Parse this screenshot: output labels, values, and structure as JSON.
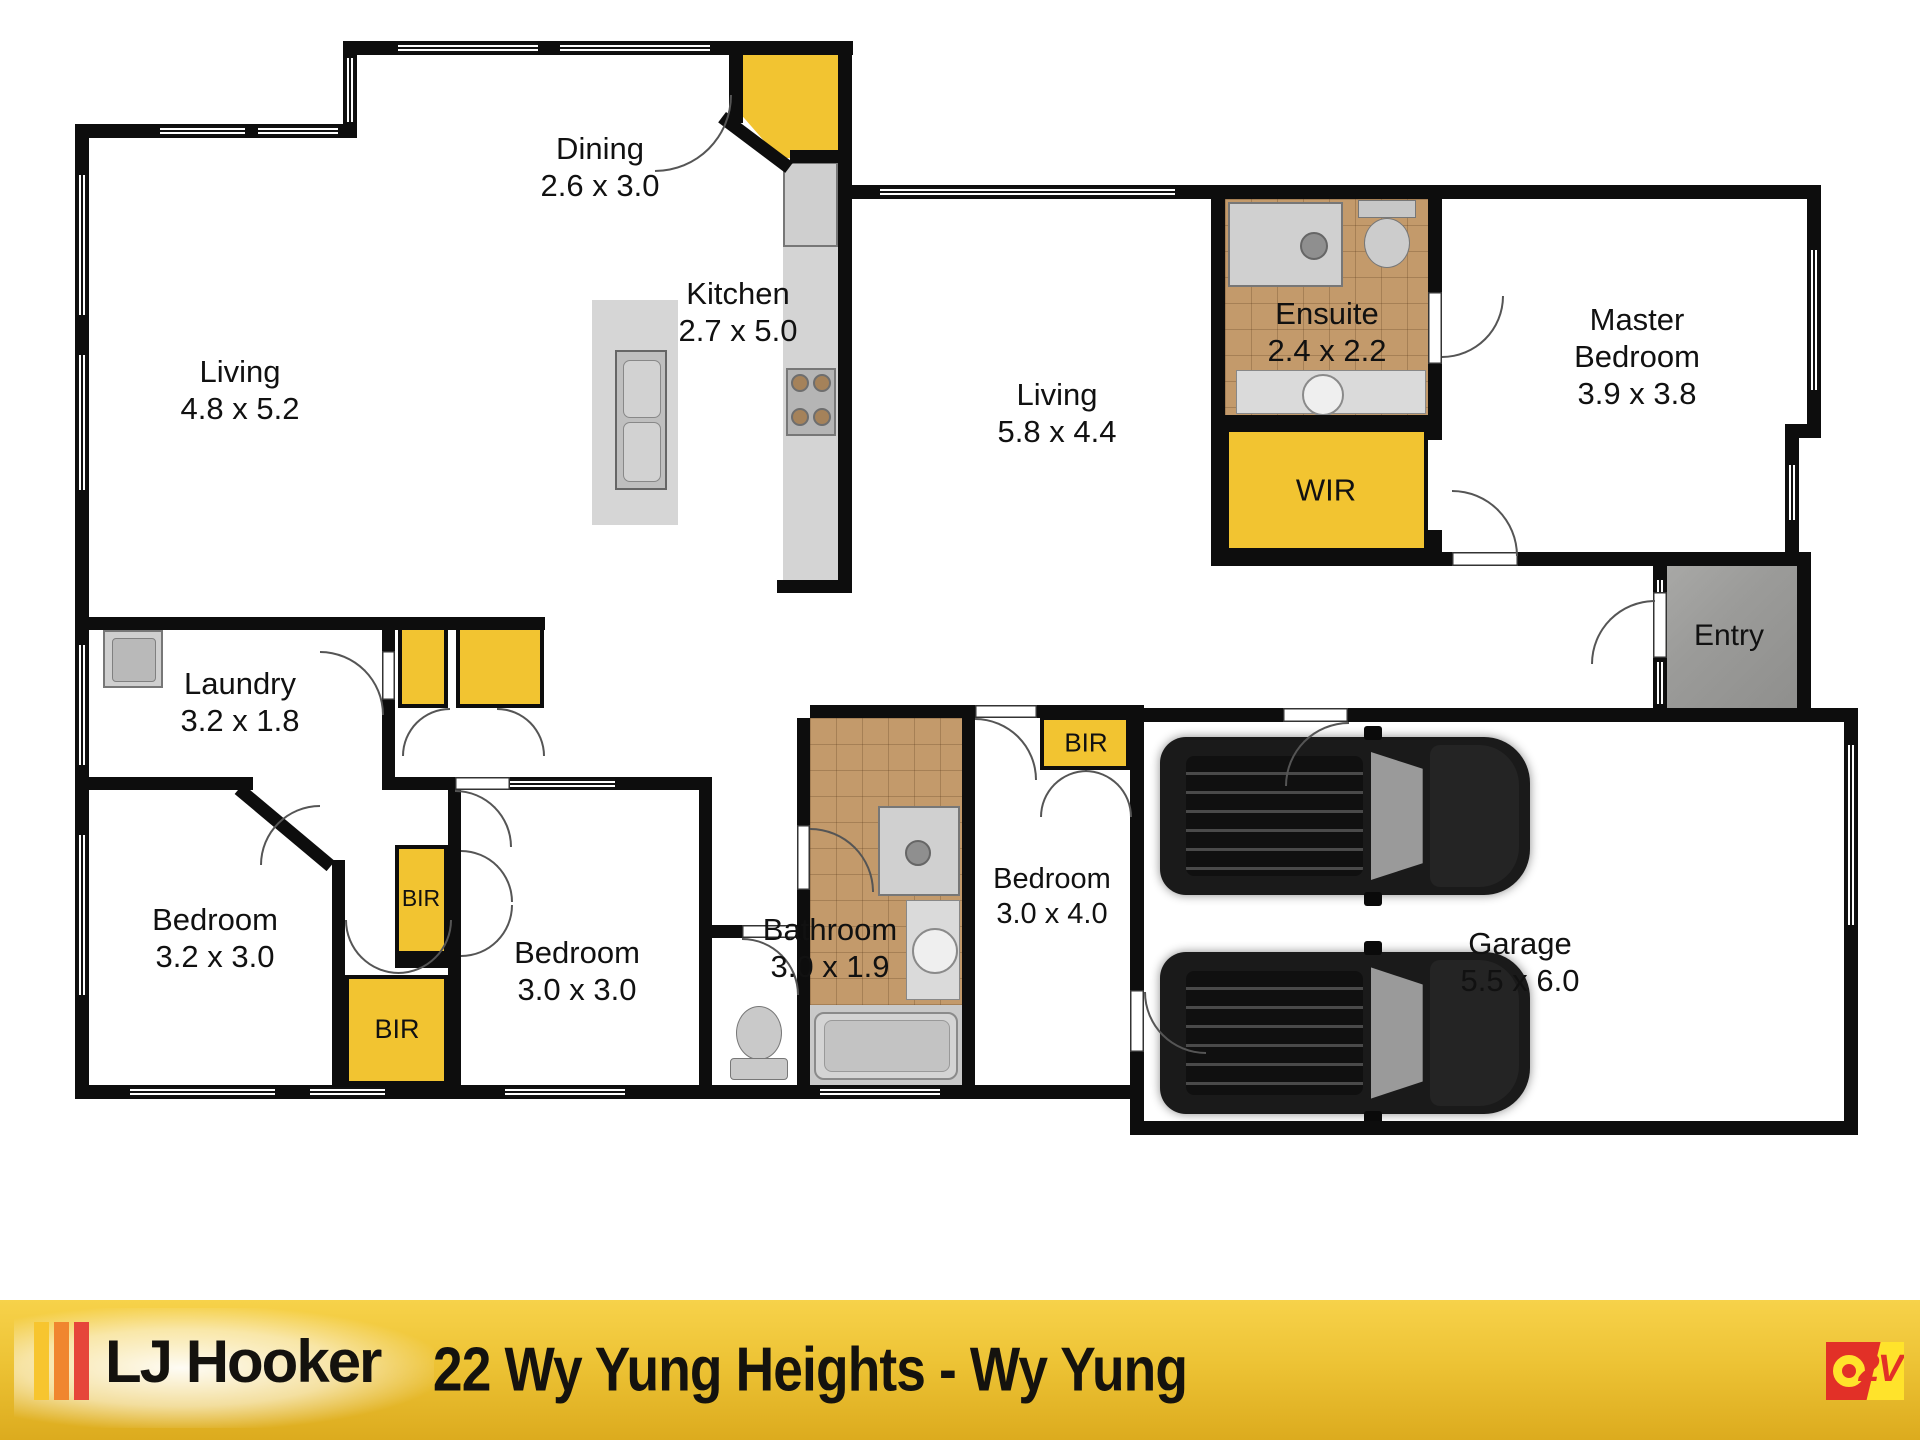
{
  "labels": {
    "living1": {
      "name": "Living",
      "dims": "4.8 x 5.2"
    },
    "dining": {
      "name": "Dining",
      "dims": "2.6 x 3.0"
    },
    "kitchen": {
      "name": "Kitchen",
      "dims": "2.7 x 5.0"
    },
    "living2": {
      "name": "Living",
      "dims": "5.8 x 4.4"
    },
    "ensuite": {
      "name": "Ensuite",
      "dims": "2.4 x 2.2"
    },
    "master": {
      "line1": "Master",
      "line2": "Bedroom",
      "dims": "3.9 x 3.8"
    },
    "wir": {
      "name": "WIR"
    },
    "entry": {
      "name": "Entry"
    },
    "laundry": {
      "name": "Laundry",
      "dims": "3.2 x 1.8"
    },
    "bir_a": {
      "name": "BIR"
    },
    "bir_b": {
      "name": "BIR"
    },
    "bir_bed4": {
      "name": "BIR"
    },
    "bedroom1": {
      "name": "Bedroom",
      "dims": "3.2 x 3.0"
    },
    "bedroom2": {
      "name": "Bedroom",
      "dims": "3.0 x 3.0"
    },
    "bathroom": {
      "name": "Bathroom",
      "dims": "3.0 x 1.9"
    },
    "bedroom4": {
      "name": "Bedroom",
      "dims": "3.0 x 4.0"
    },
    "garage": {
      "name": "Garage",
      "dims": "5.5 x 6.0"
    }
  },
  "footer": {
    "brand": "LJ Hooker",
    "address": "22 Wy Yung Heights - Wy Yung",
    "watermark": "O2V"
  },
  "colors": {
    "closet_yellow": "#F2C431",
    "tile_brown": "#C39A6B",
    "entry_gray": "#A3A3A1",
    "wall_black": "#0d0d0d",
    "footer_yellow": "#EDC335",
    "brand_bar_yellow": "#F7C52F",
    "brand_bar_orange": "#F0862F",
    "brand_bar_red": "#E6463A",
    "o2v_red": "#E23027",
    "o2v_yellow": "#FFE32B",
    "car_black": "#1A1A1A"
  },
  "icons": {
    "kitchen": [
      "island-sink-icon",
      "cooktop-icon",
      "fridge-icon",
      "pantry-corner-icon"
    ],
    "laundry": [
      "laundry-trough-icon"
    ],
    "ensuite": [
      "shower-icon",
      "toilet-icon",
      "vanity-basin-icon"
    ],
    "bathroom": [
      "shower-icon",
      "vanity-basin-icon",
      "bathtub-icon",
      "toilet-icon"
    ],
    "garage": [
      "car-icon",
      "car-icon"
    ],
    "doors": [
      "door-swing-arc-icon"
    ],
    "windows": [
      "window-strip-icon"
    ]
  }
}
